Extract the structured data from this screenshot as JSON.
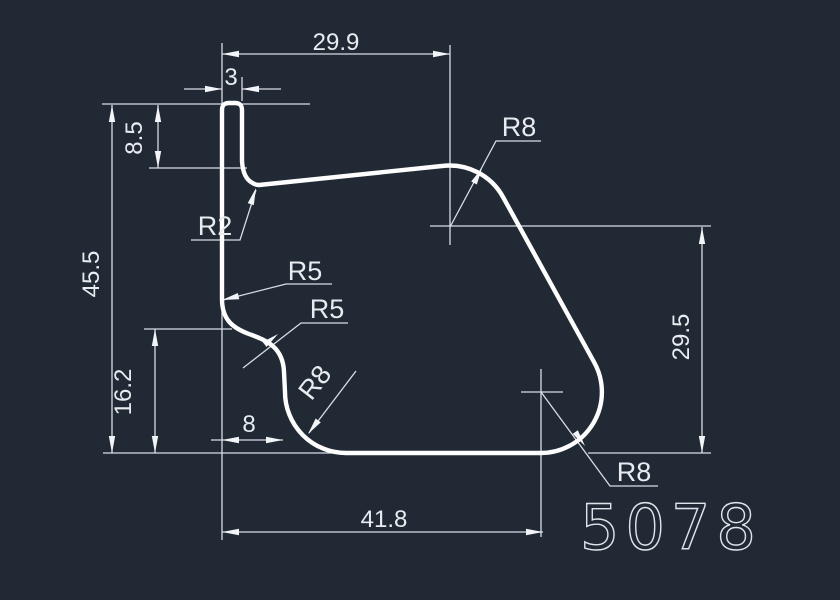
{
  "drawing": {
    "part_number": "5078",
    "background_color": "#212934",
    "outline_color": "#fdfdfd",
    "dimension_color": "#e8ecf0",
    "dimensions": {
      "top_width": "29.9",
      "tab_width": "3",
      "tab_depth": "8.5",
      "overall_height": "45.5",
      "lower_step_height": "16.2",
      "step_offset": "8",
      "bottom_width": "41.8",
      "right_height": "29.5"
    },
    "radii": {
      "top_right": "R8",
      "tab_fillet": "R2",
      "s_curve_upper": "R5",
      "s_curve_lower": "R5",
      "bottom_left": "R8",
      "bottom_right": "R8"
    }
  }
}
